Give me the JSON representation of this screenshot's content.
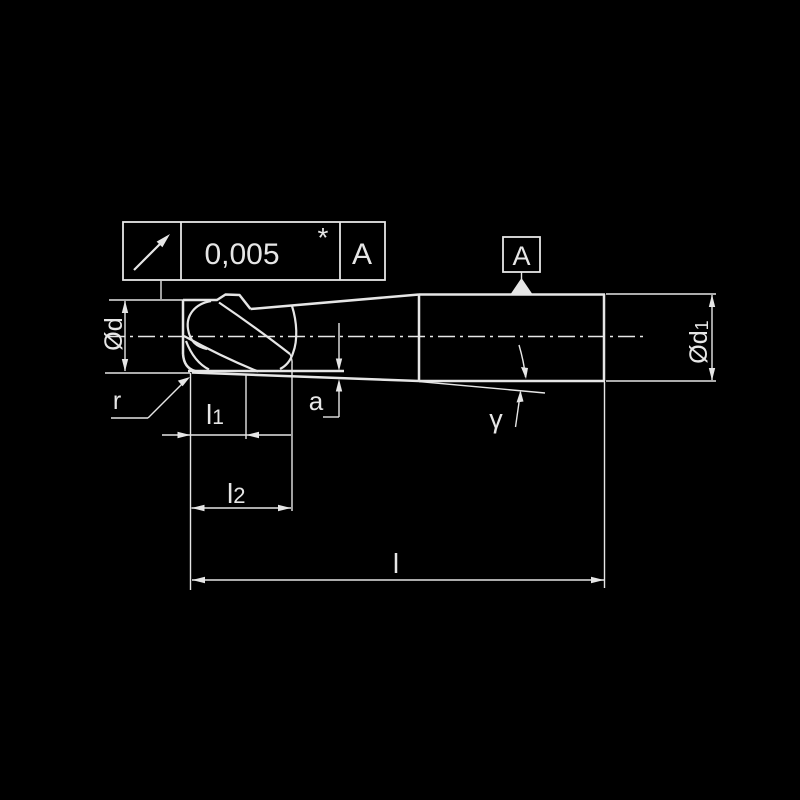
{
  "colors": {
    "background": "#000000",
    "line": "#e6e6e6"
  },
  "tolerance_frame": {
    "symbol": "circular-runout-arrow",
    "value": "0,005",
    "star": "*",
    "datum": "A"
  },
  "datum_box": {
    "label": "A"
  },
  "dimensions": {
    "tip_diameter": {
      "text": "Ød"
    },
    "shank_diameter": {
      "text": "Ød",
      "sub": "1"
    },
    "corner_radius": {
      "text": "r"
    },
    "length_1": {
      "text": "l",
      "sub": "1"
    },
    "length_2": {
      "text": "l",
      "sub": "2"
    },
    "overall_length": {
      "text": "l"
    },
    "taper_offset": {
      "text": "a"
    },
    "taper_angle": {
      "text": "γ"
    }
  }
}
